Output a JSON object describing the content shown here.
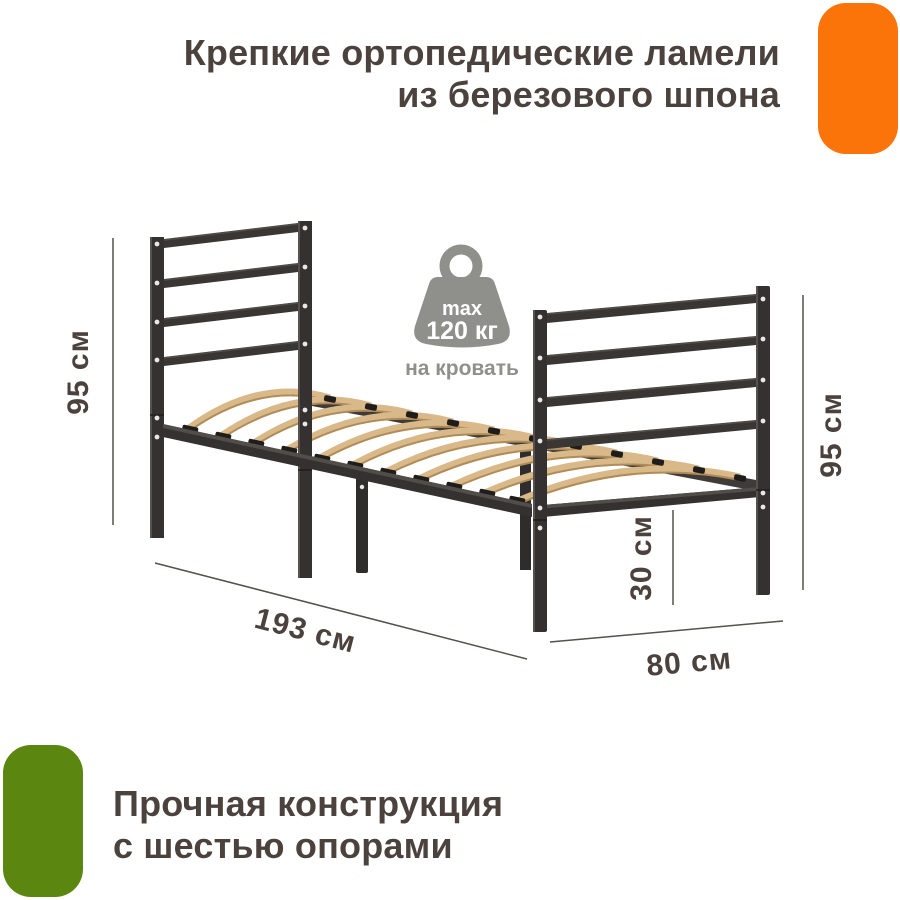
{
  "header": {
    "title_line1": "Крепкие ортопедические ламели",
    "title_line2": "из березового шпона"
  },
  "footer": {
    "title_line1": "Прочная конструкция",
    "title_line2": "с шестью опорами"
  },
  "weight_badge": {
    "max_label": "max",
    "value": "120 кг",
    "caption": "на кровать"
  },
  "dimensions": {
    "height_left": "95 см",
    "height_right": "95 см",
    "leg_clearance": "30 см",
    "length": "193 см",
    "width": "80 см"
  },
  "colors": {
    "accent_orange": "#FA7409",
    "accent_green": "#5B860F",
    "text_dark": "#4B423D",
    "metal_dark": "#343130",
    "wood_slat": "#D9B98A",
    "badge_gray": "#8F8F8B"
  }
}
